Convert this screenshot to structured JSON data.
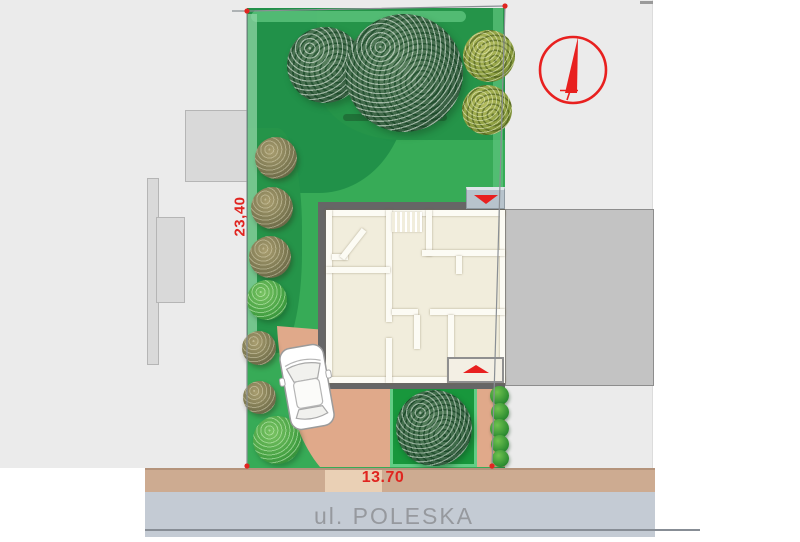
{
  "plan": {
    "dimension_left": "23,40",
    "dimension_front": "13.70",
    "street_label": "ul. POLESKA"
  },
  "icons": {
    "north_arrow": "north-arrow-icon",
    "car": "car-icon",
    "entrance_top": "entrance-arrow-down-icon",
    "entrance_bottom": "entrance-arrow-up-icon",
    "corner_markers": "plot-corner-dot-icon"
  },
  "colors": {
    "dimension_text": "#e02520",
    "north_arrow": "#e8201f",
    "street_text": "#96999e",
    "lawn": "#37ab57",
    "lawn_dark": "#219149",
    "driveway": "#e0a98a",
    "sidewalk": "#cdab91",
    "sidewalk_light": "#ead0b5",
    "street": "#c4cbd4",
    "garden": "#18973c",
    "house_floor": "#f1eddc",
    "roof_outline": "#666666",
    "neighbor_building": "#c3c3c3",
    "neighbor_area": "#ebebeb"
  }
}
